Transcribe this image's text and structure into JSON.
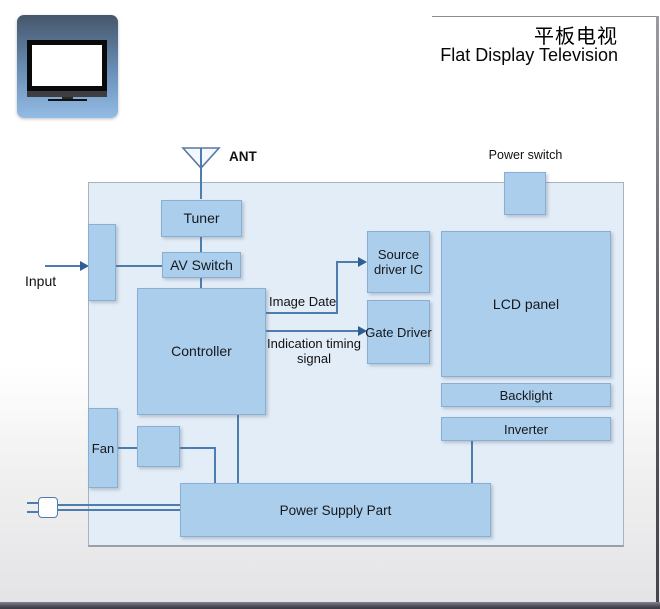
{
  "header": {
    "title_zh": "平板电视",
    "title_en": "Flat Display Television"
  },
  "labels": {
    "ant": "ANT",
    "input": "Input",
    "power_switch": "Power switch",
    "fan": "Fan",
    "image_data": "Image Date",
    "timing_signal": "Indication timing signal"
  },
  "blocks": {
    "tuner": "Tuner",
    "av_switch": "AV Switch",
    "controller": "Controller",
    "source_driver_ic": "Source driver IC",
    "gate_driver": "Gate Driver",
    "lcd_panel": "LCD panel",
    "backlight": "Backlight",
    "inverter": "Inverter",
    "power_supply": "Power Supply Part"
  },
  "colors": {
    "block_fill": "#abceec",
    "block_border": "#87afd4",
    "panel_fill": "#e3edf8",
    "connector": "#4d7dae",
    "icon_gradient_top": "#46566b",
    "icon_gradient_bottom": "#93bbe3",
    "text": "#15181c"
  }
}
